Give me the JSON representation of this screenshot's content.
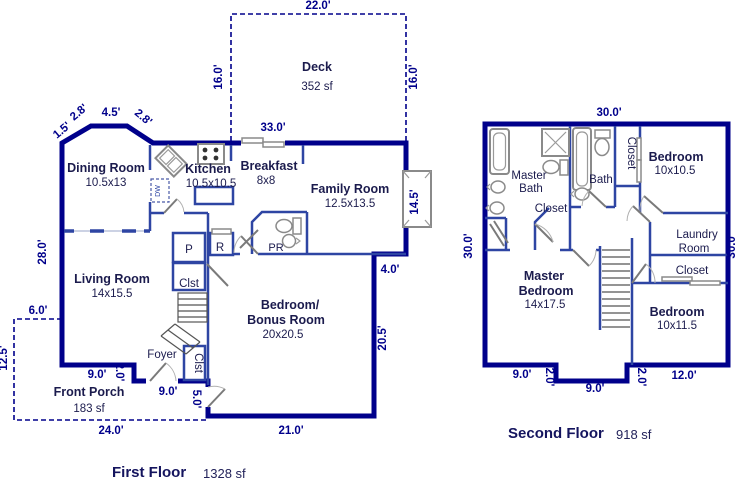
{
  "colors": {
    "wall": "#00008B",
    "interior_wall": "#2E45A3",
    "dimension_text": "#00008B",
    "room_text": "#1B1B4D",
    "fixture": "#8A8A8A",
    "background": "#FFFFFF"
  },
  "ff": {
    "title": "First Floor",
    "area": "1328 sf",
    "deck": {
      "name": "Deck",
      "area": "352 sf"
    },
    "rooms": {
      "dining": {
        "name": "Dining Room",
        "size": "10.5x13"
      },
      "kitchen": {
        "name": "Kitchen",
        "size": "10.5x10.5"
      },
      "breakfast": {
        "name": "Breakfast",
        "size": "8x8"
      },
      "family": {
        "name": "Family Room",
        "size": "12.5x13.5"
      },
      "living": {
        "name": "Living Room",
        "size": "14x15.5"
      },
      "bonus": {
        "name1": "Bedroom/",
        "name2": "Bonus Room",
        "size": "20x20.5"
      },
      "foyer": {
        "name": "Foyer"
      },
      "porch": {
        "name": "Front Porch",
        "area": "183 sf"
      },
      "powder": {
        "name": "PR"
      },
      "pantry": {
        "name": "P"
      },
      "fridge": {
        "name": "R"
      },
      "closet": {
        "name": "Clst"
      },
      "closet2": {
        "name": "Clst"
      },
      "dishwasher": {
        "name": "DW"
      }
    },
    "dims": {
      "deck_top": "22.0'",
      "deck_left": "16.0'",
      "deck_right": "16.0'",
      "top": "33.0'",
      "bay_a": "1.5'",
      "bay_b": "2.8'",
      "bay_c": "4.5'",
      "bay_d": "2.8'",
      "left": "28.0'",
      "porch_top": "6.0'",
      "porch_left": "12.5'",
      "porch_bottom": "24.0'",
      "front_a": "9.0'",
      "front_b": "2.0'",
      "front_c": "9.0'",
      "side": "5.0'",
      "bottom": "21.0'",
      "right": "20.5'",
      "step": "4.0'",
      "fireplace": "14.5'"
    }
  },
  "sf": {
    "title": "Second Floor",
    "area": "918 sf",
    "rooms": {
      "master_bath": {
        "name1": "Master",
        "name2": "Bath"
      },
      "master_closet": {
        "name": "Closet"
      },
      "bath": {
        "name": "Bath"
      },
      "bath_closet": {
        "name": "Closet"
      },
      "bedroom1": {
        "name": "Bedroom",
        "size": "10x10.5"
      },
      "laundry": {
        "name1": "Laundry",
        "name2": "Room"
      },
      "laundry_closet": {
        "name": "Closet"
      },
      "bedroom2": {
        "name": "Bedroom",
        "size": "10x11.5"
      },
      "master": {
        "name1": "Master",
        "name2": "Bedroom",
        "size": "14x17.5"
      }
    },
    "dims": {
      "top": "30.0'",
      "left": "30.0'",
      "right": "30.0'",
      "bottom_a": "9.0'",
      "notch_a": "2.0'",
      "bottom_b": "9.0'",
      "notch_b": "2.0'",
      "bottom_c": "12.0'"
    }
  }
}
